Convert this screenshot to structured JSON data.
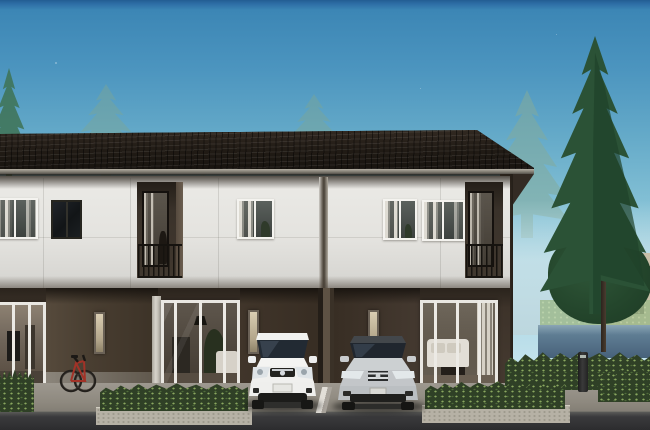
{
  "meta": {
    "title": "Townhouse exterior rendering",
    "description": "3D architectural rendering of a modern two-storey townhouse row at dusk, with recessed balconies, carports holding a white hatchback and a silver sedan, a red bicycle, trimmed hedges, pine trees and a neighbouring house behind a blue garden wall"
  },
  "scene": {
    "sky": {
      "label": "dusk sky gradient",
      "top_color": "#2e6ea6",
      "mid_color": "#66abc9",
      "horizon_color": "#cde9f0"
    },
    "roof": {
      "label": "dark concrete-tile roof",
      "color": "#1c1712"
    },
    "building": {
      "label": "two-storey townhouse row",
      "facade_color": "#e8e7e3",
      "accent_wall_color": "#3f362c",
      "units": [
        {
          "label": "unit 1 - left, partially cropped",
          "features": [
            "white framed curtained window",
            "dark framed window",
            "glass slider with TV wall",
            "carport with red bicycle",
            "frosted slot window"
          ]
        },
        {
          "label": "unit 2 - centre left",
          "features": [
            "recessed balcony with black railing",
            "curtained window",
            "living room glass slider with pendant lamp and plants",
            "carport with white hatchback"
          ]
        },
        {
          "label": "unit 3 - centre right",
          "features": [
            "two curtained windows",
            "recessed balcony with black railing",
            "carport with silver sedan",
            "living room glass slider with white sofa"
          ]
        }
      ]
    },
    "vehicles": [
      {
        "label": "white hatchback",
        "color": "#f2f2f0"
      },
      {
        "label": "silver sedan",
        "color": "#c3c6c9"
      },
      {
        "label": "red road bicycle",
        "color": "#a23227"
      }
    ],
    "landscape": {
      "pines_label": "tall pine tree",
      "faint_pines_label": "misty background pines",
      "pine_color": "#2b5236",
      "faint_pine_color": "#7ca695",
      "hedge_label": "trimmed hedge planter",
      "hedge_color": "#2f4026",
      "garden_wall_label": "blue-grey garden wall",
      "garden_wall_color": "#5f7d93",
      "background_house_label": "neighbouring house",
      "bollard_label": "garden bollard light",
      "garden_tree_label": "garden tree"
    },
    "ground": {
      "driveway_label": "concrete driveway",
      "driveway_color": "#96918a",
      "road_label": "asphalt road",
      "road_color": "#2f2f31",
      "curb_color": "#b6b1a5"
    }
  }
}
